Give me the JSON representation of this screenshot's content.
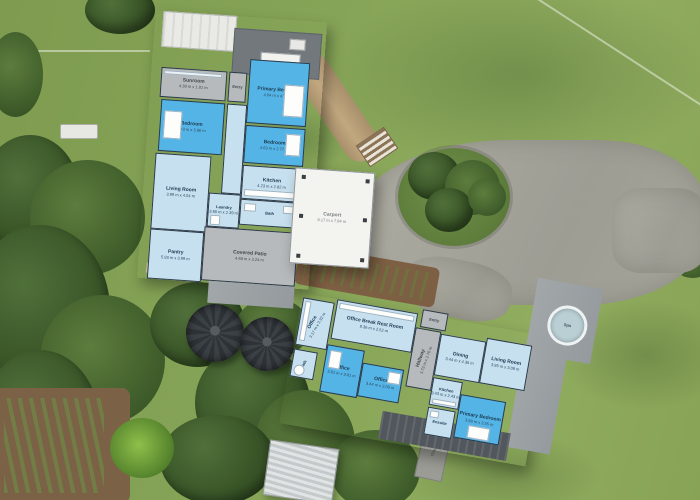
{
  "colors": {
    "room_light": "#c7e0ef",
    "room_highlight": "#55b4e6",
    "wall": "#2c3a47",
    "room_gray": "#b6babc",
    "carport_white": "#f3f3ef",
    "deck_gray": "#9ca1a4",
    "lawn_green": "#86a457",
    "gravel_gray": "#a3a39a"
  },
  "main_house": {
    "rooms": [
      {
        "name": "Sunroom",
        "dims": "4.38 m x 1.81 m"
      },
      {
        "name": "Entry",
        "dims": ""
      },
      {
        "name": "Primary Bedroom",
        "dims": "4.04 m x 4.39 m"
      },
      {
        "name": "Bedroom",
        "dims": "4.43 m x 3.86 m"
      },
      {
        "name": "Bedroom",
        "dims": "4.63 m x 2.77 m"
      },
      {
        "name": "Living Room",
        "dims": "3.99 m x 4.04 m"
      },
      {
        "name": "Kitchen",
        "dims": "4.23 m x 2.82 m"
      },
      {
        "name": "Bath",
        "dims": ""
      },
      {
        "name": "Laundry",
        "dims": "3.60 m x 2.39 m"
      },
      {
        "name": "Pantry",
        "dims": "5.83 m x 3.99 m"
      },
      {
        "name": "Covered Patio",
        "dims": "4.68 m x 3.24 m"
      },
      {
        "name": "Carport",
        "dims": "8.17 m x 7.94 m"
      }
    ]
  },
  "second_dwelling": {
    "rooms": [
      {
        "name": "Office",
        "dims": "3.17 m x 3.32 m"
      },
      {
        "name": "Bath",
        "dims": ""
      },
      {
        "name": "Office",
        "dims": "2.81 m x 3.81 m"
      },
      {
        "name": "Office",
        "dims": "3.44 m x 2.09 m"
      },
      {
        "name": "Office Break Rest Room",
        "dims": "9.36 m x 2.52 m"
      },
      {
        "name": "Hallway",
        "dims": "3.73 m x 2.76 m"
      },
      {
        "name": "Entry",
        "dims": ""
      },
      {
        "name": "Dining",
        "dims": "3.44 m x 4.36 m"
      },
      {
        "name": "Living Room",
        "dims": "3.85 m x 3.09 m"
      },
      {
        "name": "Kitchen",
        "dims": "3.43 m x 2.43 m"
      },
      {
        "name": "Ensuite",
        "dims": ""
      },
      {
        "name": "Primary Bedroom",
        "dims": "3.88 m x 3.55 m"
      }
    ]
  },
  "site": {
    "spa_label": "Spa",
    "gravel_label": "Gravel"
  }
}
